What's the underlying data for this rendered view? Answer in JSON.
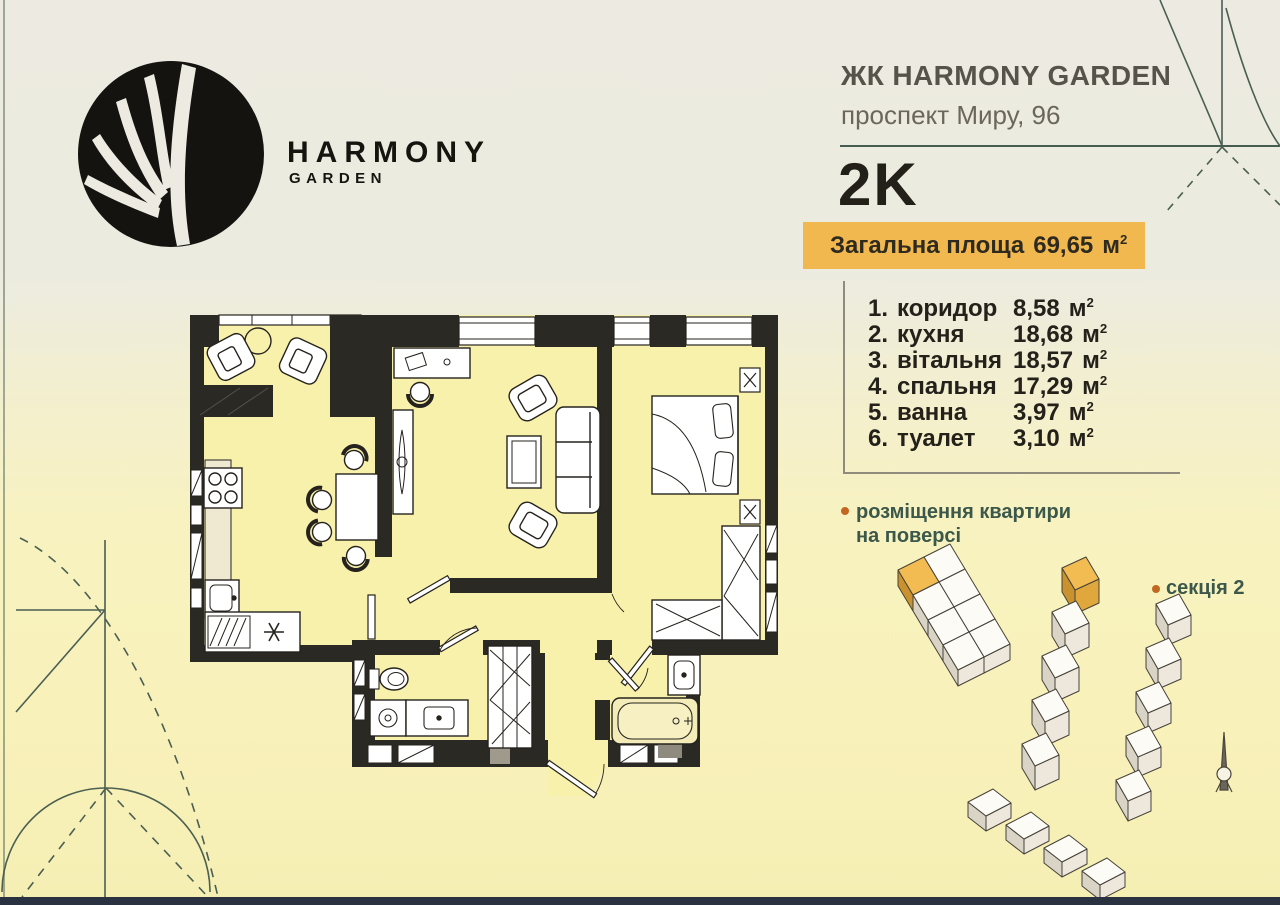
{
  "header": {
    "logo_title": "HARMONY",
    "logo_subtitle": "GARDEN",
    "complex_name": "ЖК HARMONY GARDEN",
    "address": "проспект Миру, 96",
    "apartment_type": "2K"
  },
  "badge": {
    "label": "Загальна площа",
    "value": "69,65",
    "unit": "м",
    "unit_exp": "2"
  },
  "unit": {
    "symbol": "м",
    "exp": "2"
  },
  "room_list": [
    {
      "num": "1.",
      "name": "коридор",
      "area": "8,58"
    },
    {
      "num": "2.",
      "name": "кухня",
      "area": "18,68"
    },
    {
      "num": "3.",
      "name": "вітальня",
      "area": "18,57"
    },
    {
      "num": "4.",
      "name": "спальня",
      "area": "17,29"
    },
    {
      "num": "5.",
      "name": "ванна",
      "area": "3,97"
    },
    {
      "num": "6.",
      "name": "туалет",
      "area": "3,10"
    }
  ],
  "site_plan": {
    "caption_line1": "розміщення квартири",
    "caption_line2": "на поверсі",
    "section_label": "секція 2"
  },
  "icons": {
    "logo_mark": "leaf-circle-logo",
    "bullets": "orange-dot",
    "north_arrow": "compass-north-spike"
  },
  "colors": {
    "accent_orange": "#f0b84e",
    "highlight_unit_orange": "#f2bc52",
    "deco_green": "#4a5f52",
    "caption_green": "#3b584a",
    "bullet_orange": "#c2671f",
    "wall_dark": "#2b2924",
    "room_fill": "#f8f1ac",
    "footer_bar": "#2a3140",
    "bg_top": "#edebe1",
    "bg_bottom": "#f6efb4"
  }
}
